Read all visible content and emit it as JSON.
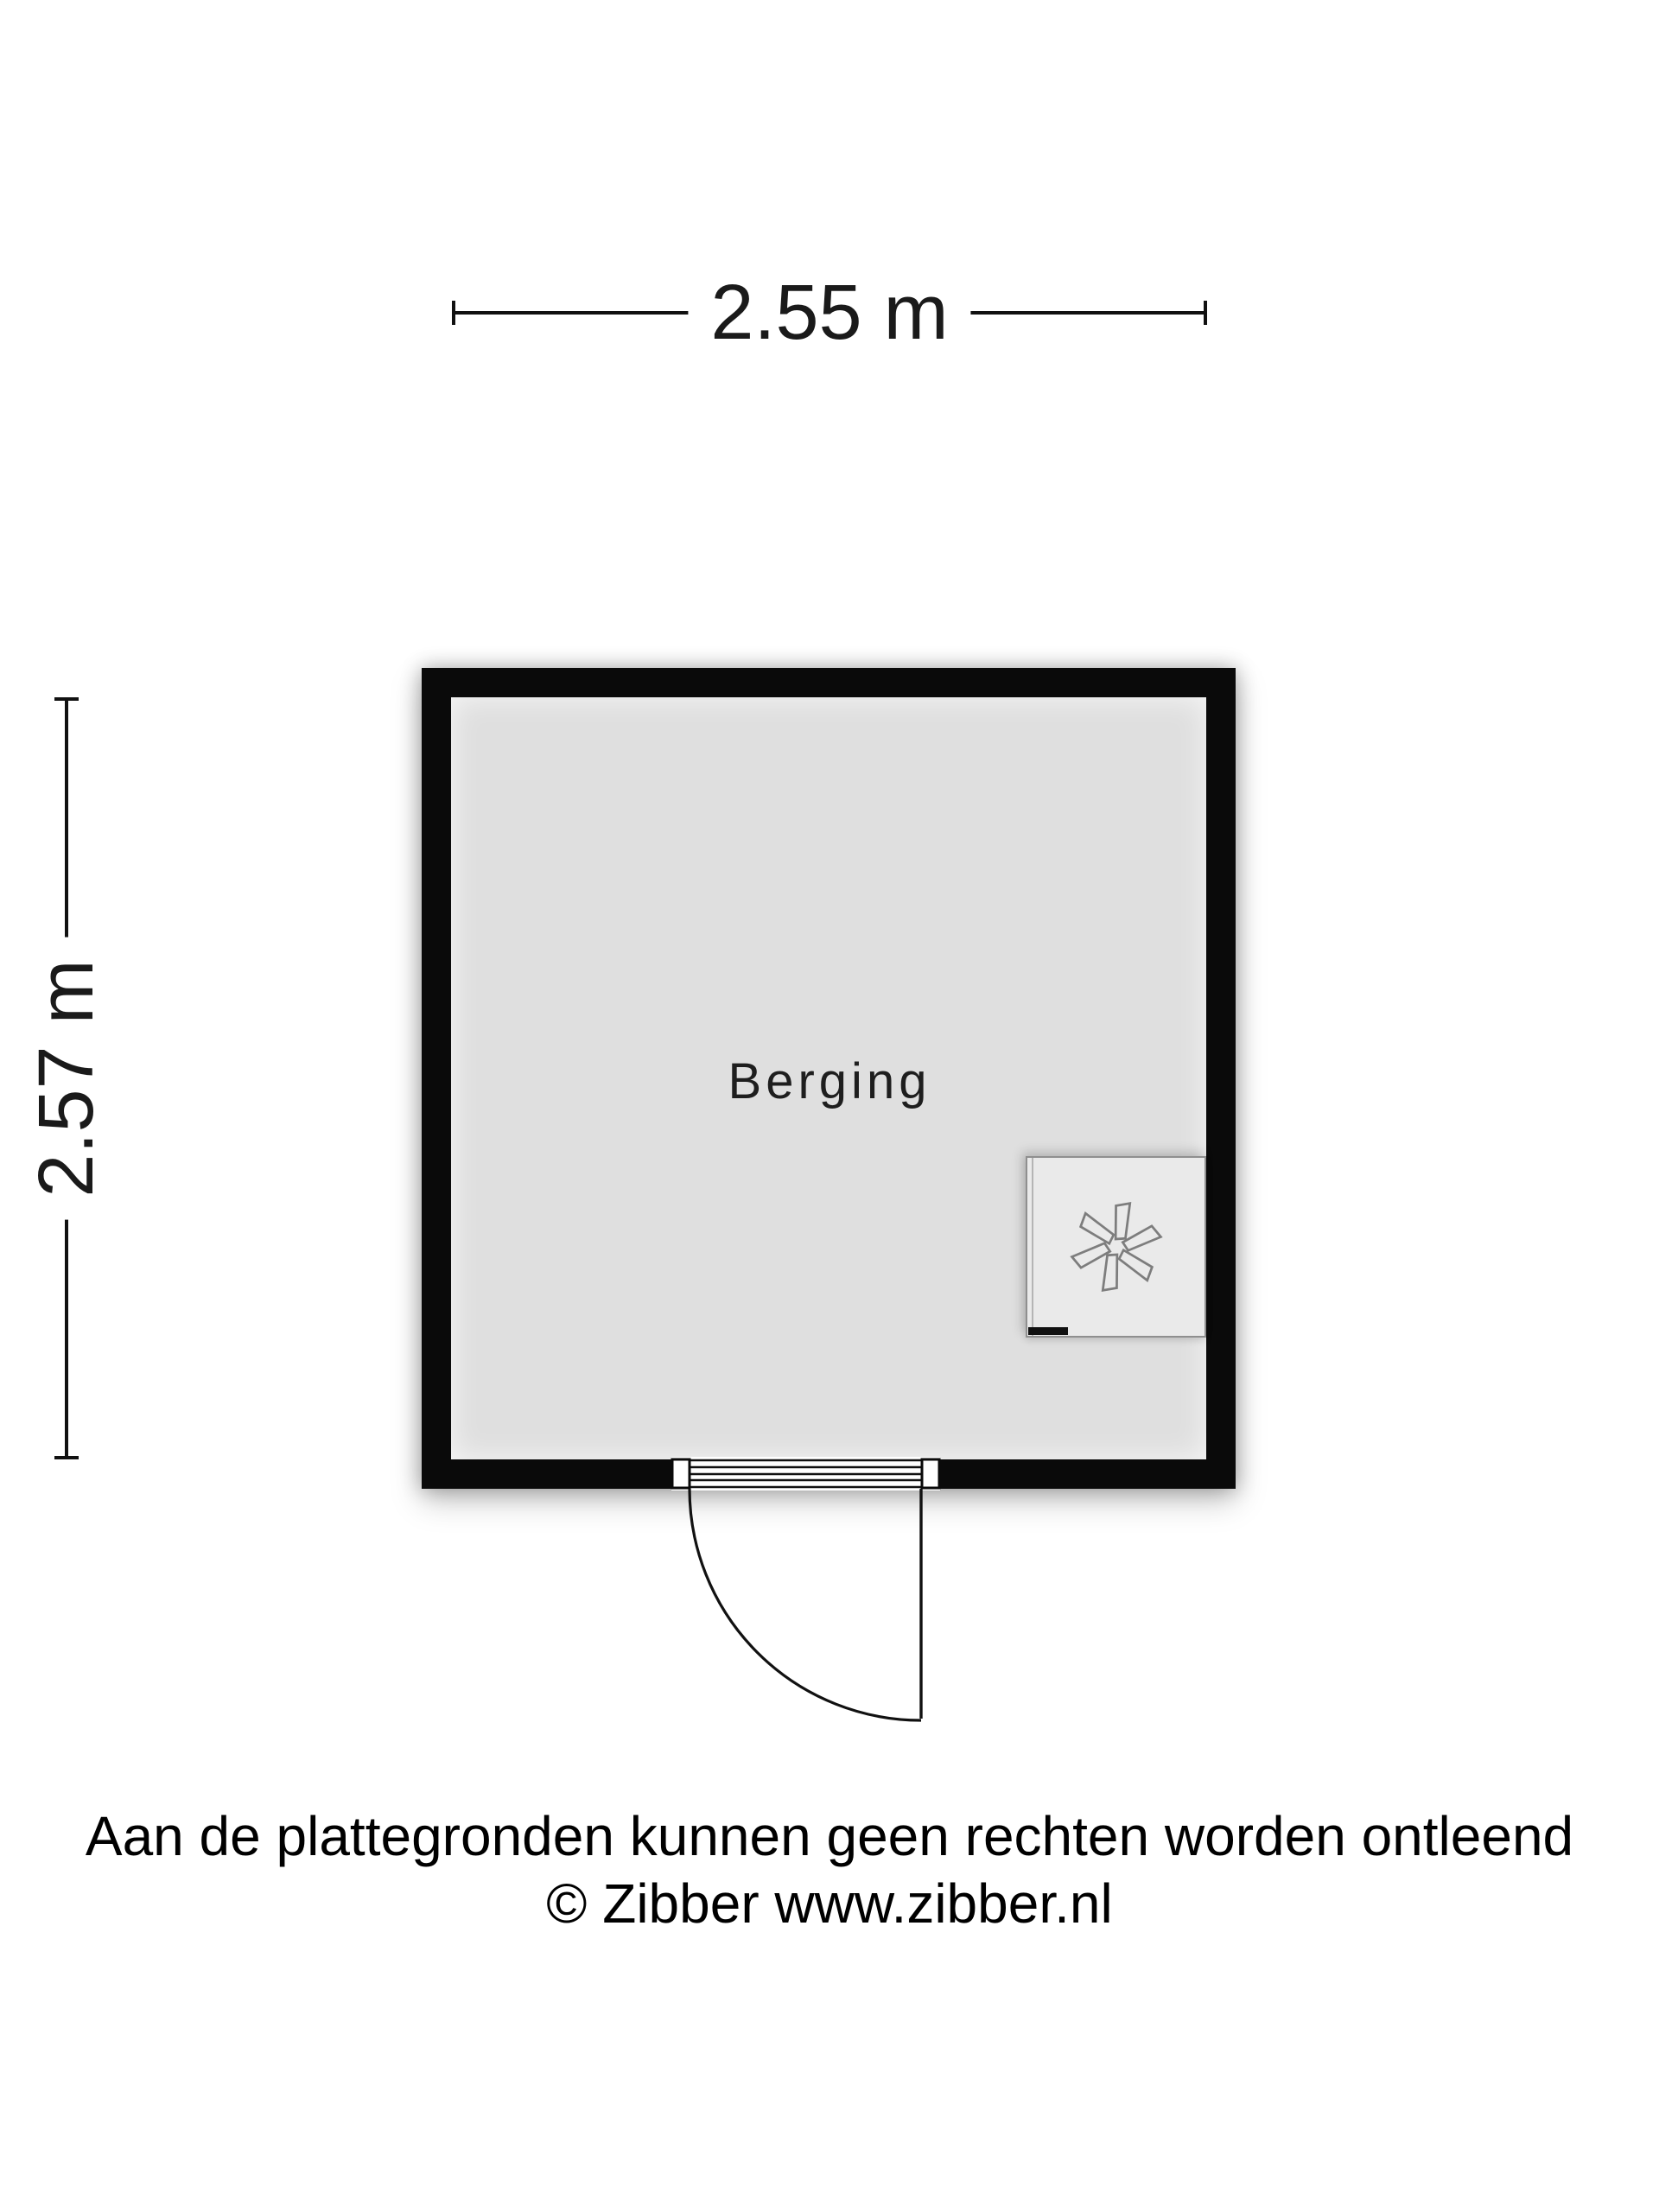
{
  "plan": {
    "type": "floorplan",
    "wall_color": "#0a0a0a",
    "floor_color": "#dfdfdf",
    "background_color": "#ffffff"
  },
  "dimensions": {
    "width": {
      "label": "2.55 m"
    },
    "height": {
      "label": "2.57 m"
    }
  },
  "room": {
    "name": "Berging"
  },
  "appliance": {
    "icon": "fan-icon"
  },
  "footer": {
    "line1": "Aan de plattegronden kunnen geen rechten worden ontleend",
    "line2": "© Zibber www.zibber.nl"
  }
}
